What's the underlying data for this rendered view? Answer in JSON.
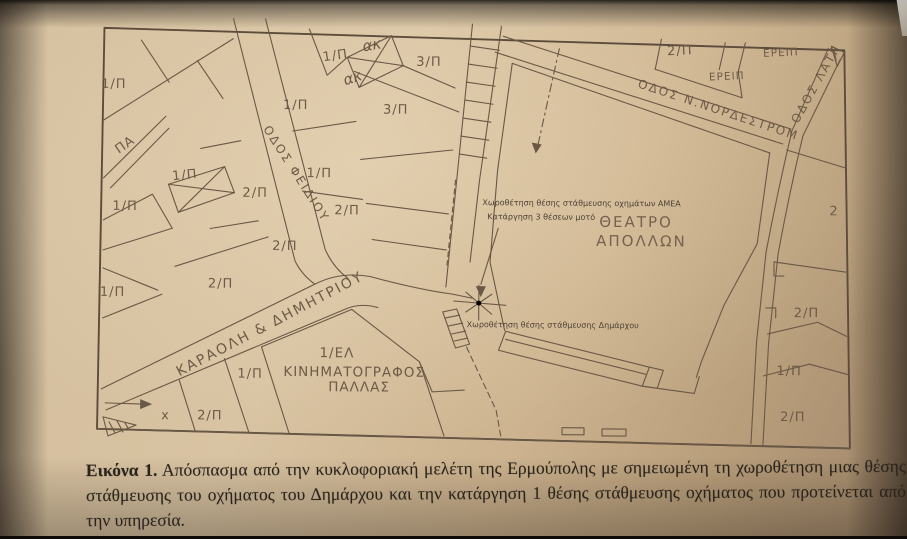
{
  "caption": {
    "label": "Εικόνα 1.",
    "text": "Απόσπασμα από την κυκλοφοριακή μελέτη της Ερμούπολης με σημειωμένη τη χωροθέτηση μιας θέσης στάθμευσης του οχήματος του Δημάρχου και την κατάργηση 1 θέσης στάθμευσης οχήματος που προτείνεται από την υπηρεσία."
  },
  "map": {
    "streets": {
      "fidiou": "ΟΔΟΣ ΦΕΙΔΙΟΥ",
      "karaoli": "ΚΑΡΑΟΛΗ & ΔΗΜΗΤΡΙΟΥ",
      "nordestrom": "ΟΔΟΣ Ν.ΝΟΡΔΕΣΤΡΟΜ",
      "latr": "ΟΔΟΣ ΛΑΤΡ"
    },
    "buildings": {
      "theater_line1": "ΘΕΑΤΡΟ",
      "theater_line2": "ΑΠΟΛΛΩΝ",
      "cinema_code": "1/ΕΛ",
      "cinema_line1": "ΚΙΝΗΜΑΤΟΓΡΑΦΟΣ",
      "cinema_line2": "ΠΑΛΛΑΣ"
    },
    "annotations": {
      "amea_line1": "Χωροθέτηση θέσης στάθμευσης οχημάτων ΑΜΕΑ",
      "amea_line2": "Κατάργηση 3 θέσεων μοτό",
      "mayor": "Χωροθέτηση θέσης στάθμευσης Δημάρχου"
    },
    "plot_labels": [
      {
        "text": "1/Π"
      },
      {
        "text": "ακ"
      },
      {
        "text": "ακ"
      },
      {
        "text": "3/Π"
      },
      {
        "text": "3/Π"
      },
      {
        "text": "1/Π"
      },
      {
        "text": "1/Π"
      },
      {
        "text": "ΠΑ"
      },
      {
        "text": "1/Π"
      },
      {
        "text": "1/Π"
      },
      {
        "text": "2/Π"
      },
      {
        "text": "1/Π"
      },
      {
        "text": "2/Π"
      },
      {
        "text": "2/Π"
      },
      {
        "text": "2/Π"
      },
      {
        "text": "1/Π"
      },
      {
        "text": "1/Π"
      },
      {
        "text": "x"
      },
      {
        "text": "2/Π"
      },
      {
        "text": "2/Π"
      },
      {
        "text": "ΕΡΕΙΠ"
      },
      {
        "text": "ΕΡΕΙΠ"
      },
      {
        "text": "2"
      },
      {
        "text": "2/Π"
      },
      {
        "text": "1/Π"
      },
      {
        "text": "2/Π"
      }
    ]
  }
}
